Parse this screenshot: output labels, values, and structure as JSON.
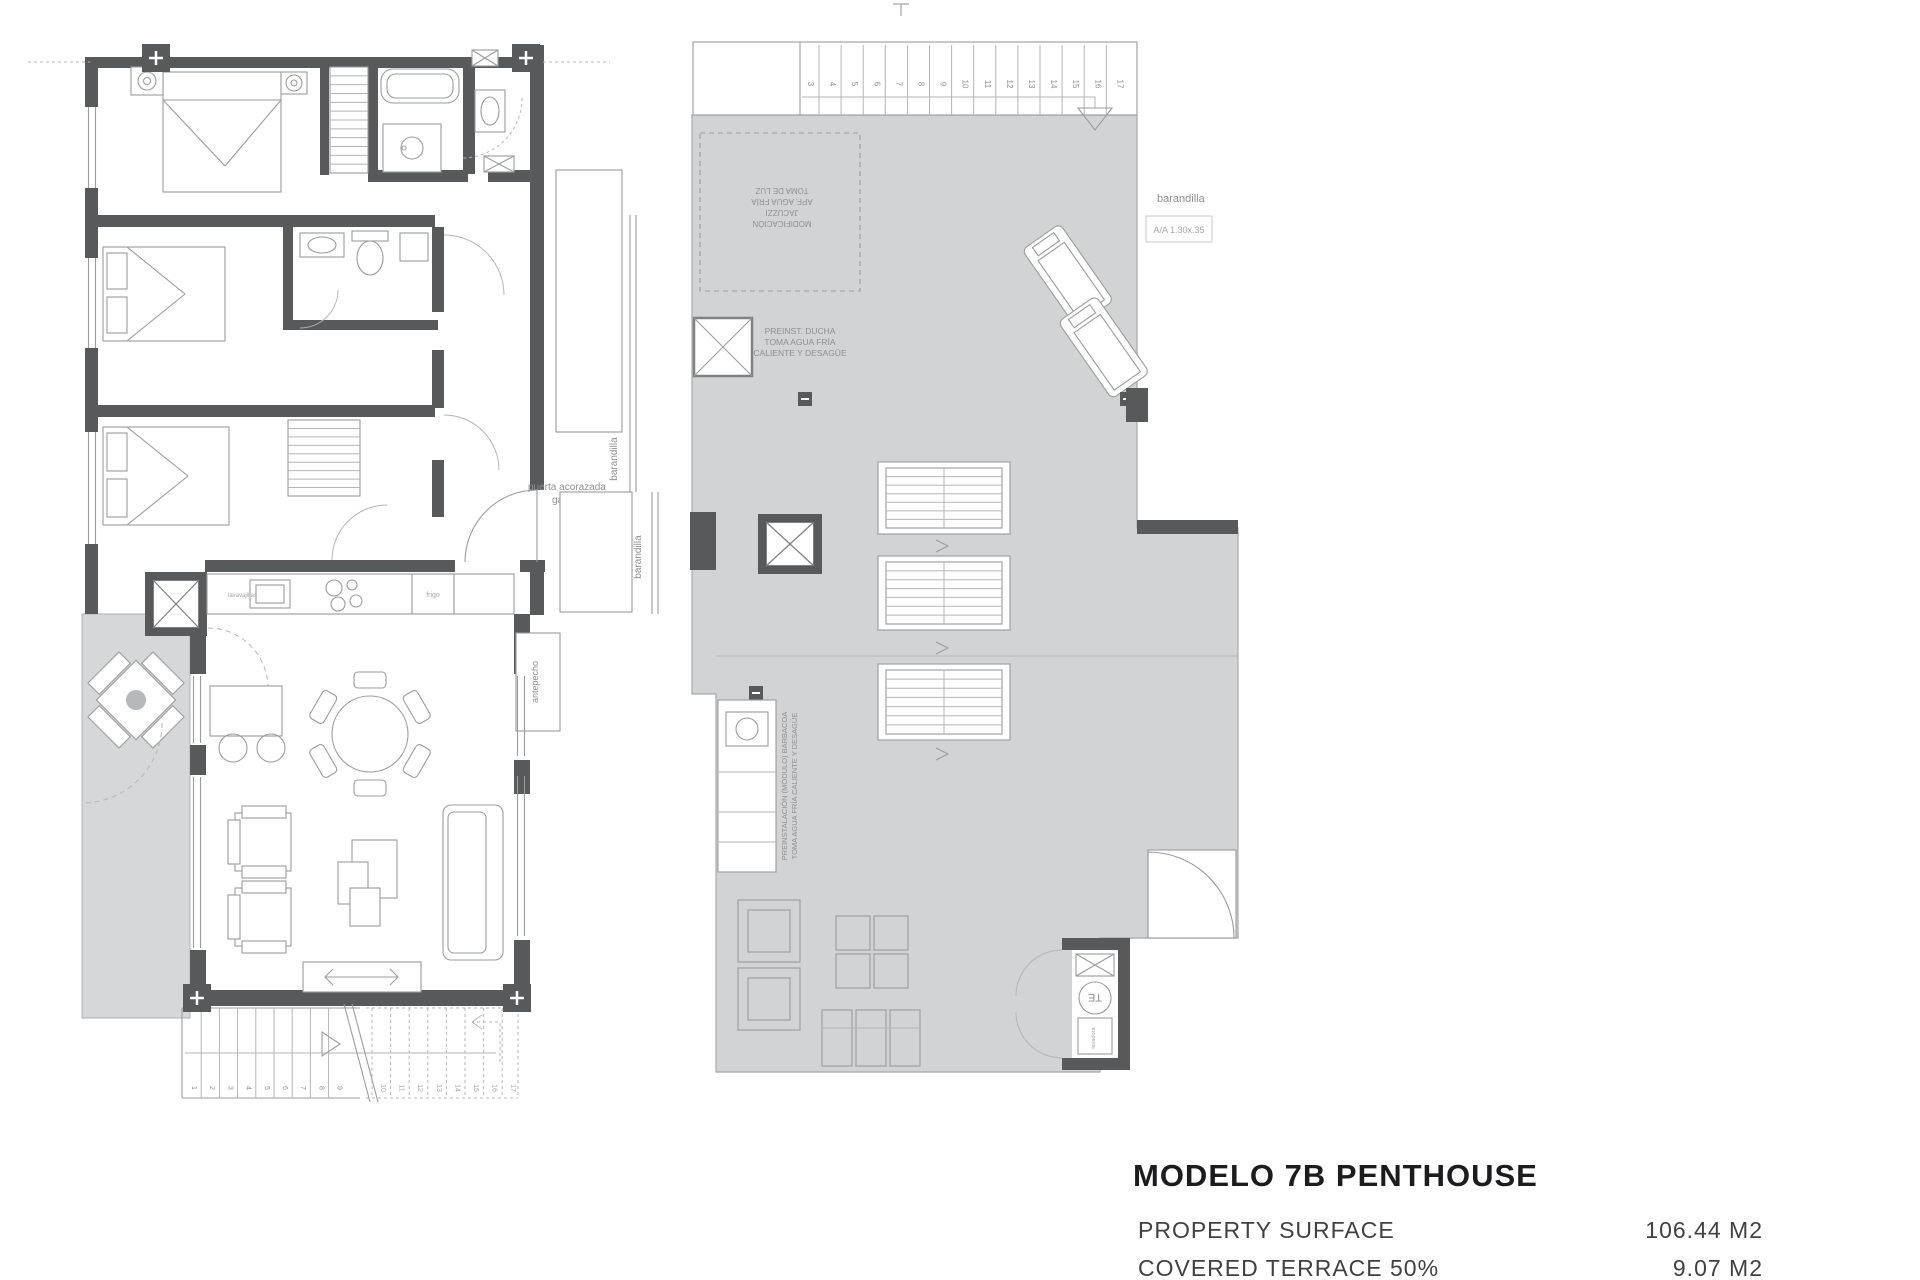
{
  "page": {
    "background": "#ffffff"
  },
  "colors": {
    "wall": "#58595b",
    "terrace_fill": "#d6d7d8",
    "solarium_fill": "#d2d3d5",
    "line": "#9b9c9e",
    "label": "#8e8f91",
    "title": "#1c1c1e",
    "subtitle": "#404144"
  },
  "title_block": {
    "title": "MODELO 7B PENTHOUSE",
    "rows": [
      {
        "label": "PROPERTY SURFACE",
        "value": "106.44 M2"
      },
      {
        "label": "COVERED TERRACE 50%",
        "value": "9.07 M2"
      }
    ]
  },
  "lower_floor": {
    "labels": {
      "entrance_line1": "puerta acorazada",
      "entrance_line2": "gardesa",
      "railing_upper": "barandilla",
      "railing_lower": "barandilla",
      "side_panel": "antepecho",
      "dishwasher": "lavavajillas",
      "fridge": "frigo"
    },
    "stair_numbers_solid": [
      "1",
      "2",
      "3",
      "4",
      "5",
      "6",
      "7",
      "8",
      "9"
    ],
    "stair_numbers_dashed": [
      "10",
      "11",
      "12",
      "13",
      "14",
      "15",
      "16",
      "17"
    ]
  },
  "upper_floor": {
    "labels": {
      "railing": "barandilla",
      "ac_unit": "A/A 1.30x.35",
      "shower_note": [
        "PREINST. DUCHA",
        "TOMA AGUA FRÍA",
        "CALIENTE Y DESAGÜE"
      ],
      "modification_note": [
        "MODIFICACIÓN",
        "JACUZZI",
        "APF. AGUA FRÍA",
        "TOMA DE LUZ"
      ],
      "barbecue_note": [
        "PREINSTALACIÓN (MÓDULO) BARBACOA",
        "TOMA AGUA FRÍA CALIENTE Y DESAGÜE"
      ],
      "water_heater": "TE",
      "washer": "lavadora"
    },
    "stair_numbers": [
      "3",
      "4",
      "5",
      "6",
      "7",
      "8",
      "9",
      "10",
      "11",
      "12",
      "13",
      "14",
      "15",
      "16",
      "17"
    ]
  }
}
